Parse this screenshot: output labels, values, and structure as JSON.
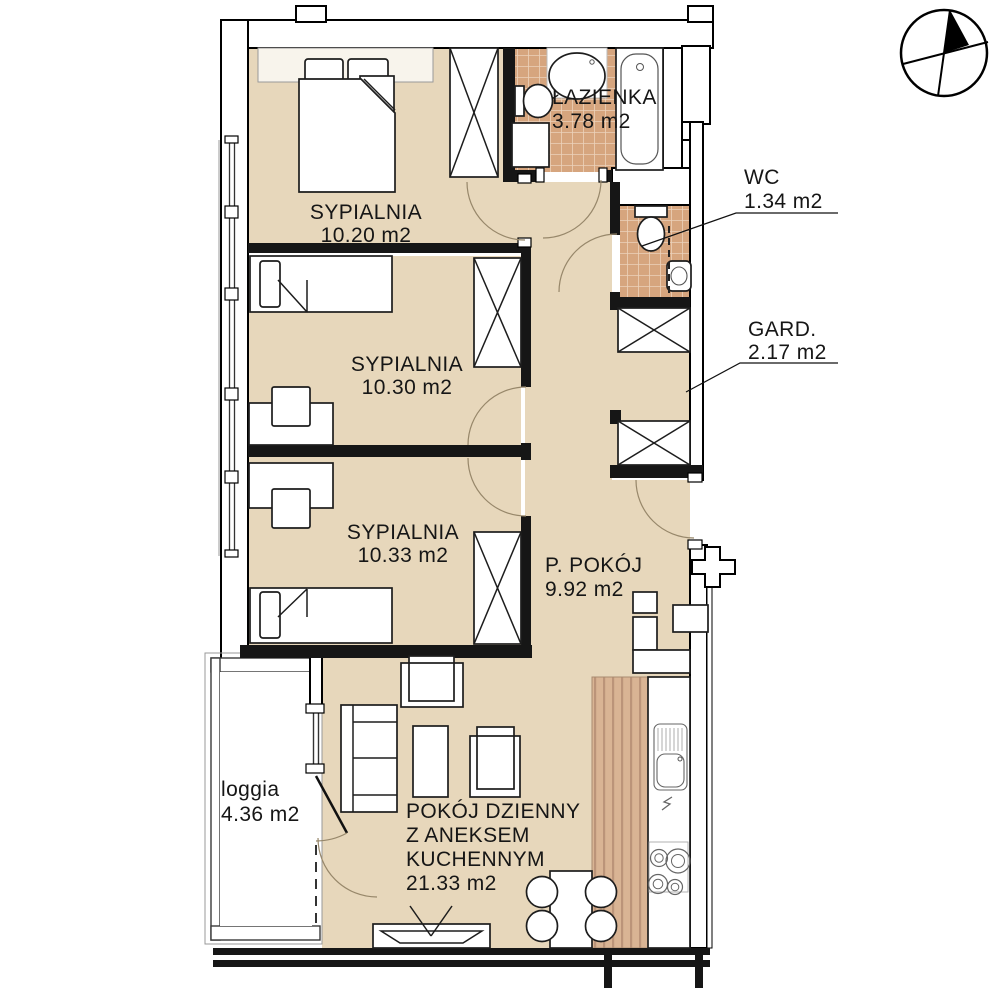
{
  "colors": {
    "floor": "#e7d7bb",
    "tile": "#d6a57e",
    "tile_grout": "#ecd2ba",
    "wood": "#d9b494",
    "wall": "#161616",
    "background": "#ffffff"
  },
  "rooms": {
    "sypialnia1": {
      "name": "SYPIALNIA",
      "area": "10.20 m2"
    },
    "sypialnia2": {
      "name": "SYPIALNIA",
      "area": "10.30 m2"
    },
    "sypialnia3": {
      "name": "SYPIALNIA",
      "area": "10.33 m2"
    },
    "lazienka": {
      "name": "ŁAZIENKA",
      "area": "3.78 m2"
    },
    "wc": {
      "name": "WC",
      "area": "1.34 m2"
    },
    "gard": {
      "name": "GARD.",
      "area": "2.17 m2"
    },
    "ppokoj": {
      "name": "P. POKÓJ",
      "area": "9.92 m2"
    },
    "living": {
      "name_line1": "POKÓJ DZIENNY",
      "name_line2": "Z ANEKSEM",
      "name_line3": "KUCHENNYM",
      "area": "21.33 m2"
    },
    "loggia": {
      "name": "loggia",
      "area": "4.36 m2"
    }
  }
}
